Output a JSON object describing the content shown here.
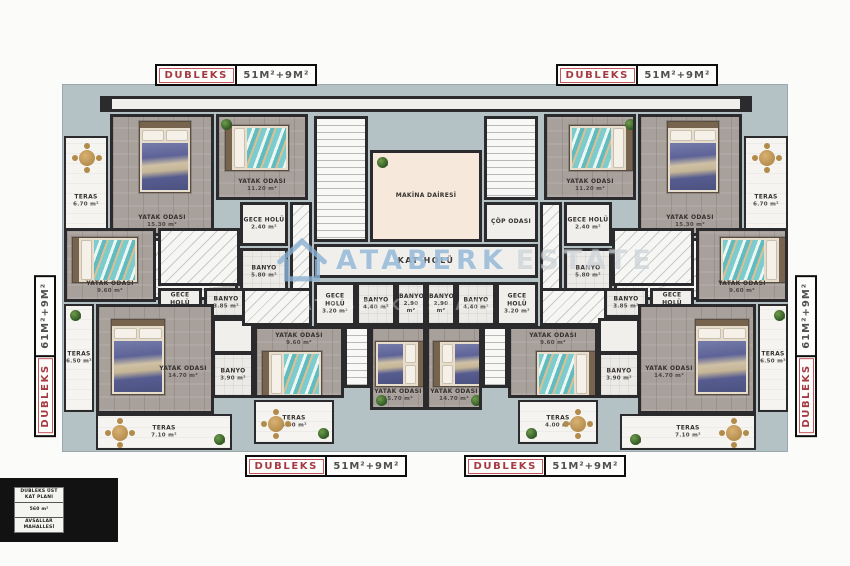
{
  "plan": {
    "unit_labels": {
      "top_left": {
        "name": "DUBLEKS",
        "area": "51M²+9M²"
      },
      "top_right": {
        "name": "DUBLEKS",
        "area": "51M²+9M²"
      },
      "bottom_left": {
        "name": "DUBLEKS",
        "area": "51M²+9M²"
      },
      "bottom_right": {
        "name": "DUBLEKS",
        "area": "51M²+9M²"
      },
      "side_left": {
        "name": "DUBLEKS",
        "area": "61M²+9M²"
      },
      "side_right": {
        "name": "DUBLEKS",
        "area": "61M²+9M²"
      }
    },
    "footer": {
      "title_line1": "DUBLEKS ÜST",
      "title_line2": "KAT PLANI",
      "area": "560 m²",
      "location_line1": "AVSALLAR",
      "location_line2": "MAHALLESİ"
    },
    "watermark": {
      "brand": "ATABERK",
      "brand2": "ESTATE",
      "ghost": "ATABERK ESTATE"
    },
    "rooms": {
      "teras_tl": {
        "label": "TERAS",
        "area": "6.70 m²"
      },
      "bed_tl_big": {
        "label": "YATAK ODASI",
        "area": "15.30 m²"
      },
      "bed_tl_small": {
        "label": "YATAK ODASI",
        "area": "11.20 m²"
      },
      "gece_tl": {
        "label": "GECE HOLÜ",
        "area": "2.40 m²"
      },
      "banyo_tl": {
        "label": "BANYO",
        "area": "5.80 m²"
      },
      "teras_tr": {
        "label": "TERAS",
        "area": "6.70 m²"
      },
      "bed_tr_big": {
        "label": "YATAK ODASI",
        "area": "15.30 m²"
      },
      "bed_tr_small": {
        "label": "YATAK ODASI",
        "area": "11.20 m²"
      },
      "gece_tr": {
        "label": "GECE HOLÜ",
        "area": "2.40 m²"
      },
      "banyo_tr": {
        "label": "BANYO",
        "area": "5.80 m²"
      },
      "makina": {
        "label": "MAKİNA DAİRESİ"
      },
      "cop": {
        "label": "ÇÖP ODASI"
      },
      "kat_holu": {
        "label": "KAT HOLÜ"
      },
      "gece_cl": {
        "label": "GECE HOLÜ",
        "area": "3.20 m²"
      },
      "banyo_cl1": {
        "label": "BANYO",
        "area": "4.40 m²"
      },
      "banyo_cl2": {
        "label": "BANYO",
        "area": "2.90 m²"
      },
      "banyo_cr2": {
        "label": "BANYO",
        "area": "2.90 m²"
      },
      "banyo_cr1": {
        "label": "BANYO",
        "area": "4.40 m²"
      },
      "gece_cr": {
        "label": "GECE HOLÜ",
        "area": "3.20 m²"
      },
      "bed_l_small": {
        "label": "YATAK ODASI",
        "area": "9.60 m²"
      },
      "gece_l": {
        "label": "GECE HOLÜ",
        "area": "1.40 m²"
      },
      "banyo_l1": {
        "label": "BANYO",
        "area": "3.85 m²"
      },
      "teras_l_side": {
        "label": "TERAS",
        "area": "6.50 m²"
      },
      "bed_l_big": {
        "label": "YATAK ODASI",
        "area": "14.70 m²"
      },
      "banyo_l2": {
        "label": "BANYO",
        "area": "3.90 m²"
      },
      "teras_l_bottom": {
        "label": "TERAS",
        "area": "7.10 m²"
      },
      "bed_cl_small": {
        "label": "YATAK ODASI",
        "area": "9.60 m²"
      },
      "bed_cl_big": {
        "label": "YATAK ODASI",
        "area": "15.70 m²"
      },
      "teras_cl": {
        "label": "TERAS",
        "area": "4.00 m²"
      },
      "bed_cr_small": {
        "label": "YATAK ODASI",
        "area": "9.60 m²"
      },
      "bed_cr_big": {
        "label": "YATAK ODASI",
        "area": "14.70 m²"
      },
      "teras_cr": {
        "label": "TERAS",
        "area": "4.00 m²"
      },
      "bed_r_small": {
        "label": "YATAK ODASI",
        "area": "9.60 m²"
      },
      "gece_r": {
        "label": "GECE HOLÜ",
        "area": "1.40 m²"
      },
      "banyo_r1": {
        "label": "BANYO",
        "area": "3.85 m²"
      },
      "teras_r_side": {
        "label": "TERAS",
        "area": "6.50 m²"
      },
      "bed_r_big": {
        "label": "YATAK ODASI",
        "area": "14.70 m²"
      },
      "banyo_r2": {
        "label": "BANYO",
        "area": "3.90 m²"
      },
      "teras_r_bottom": {
        "label": "TERAS",
        "area": "7.10 m²"
      }
    },
    "colors": {
      "plan_background": "#b4c1c5",
      "wall": "#2b2b2e",
      "accent_red": "#a63a43",
      "machine_room": "#f6e8db",
      "blue_bed": "#5c6397",
      "teal_bed": "#74c8ca",
      "watermark_blue": "#8cb2d2"
    }
  }
}
